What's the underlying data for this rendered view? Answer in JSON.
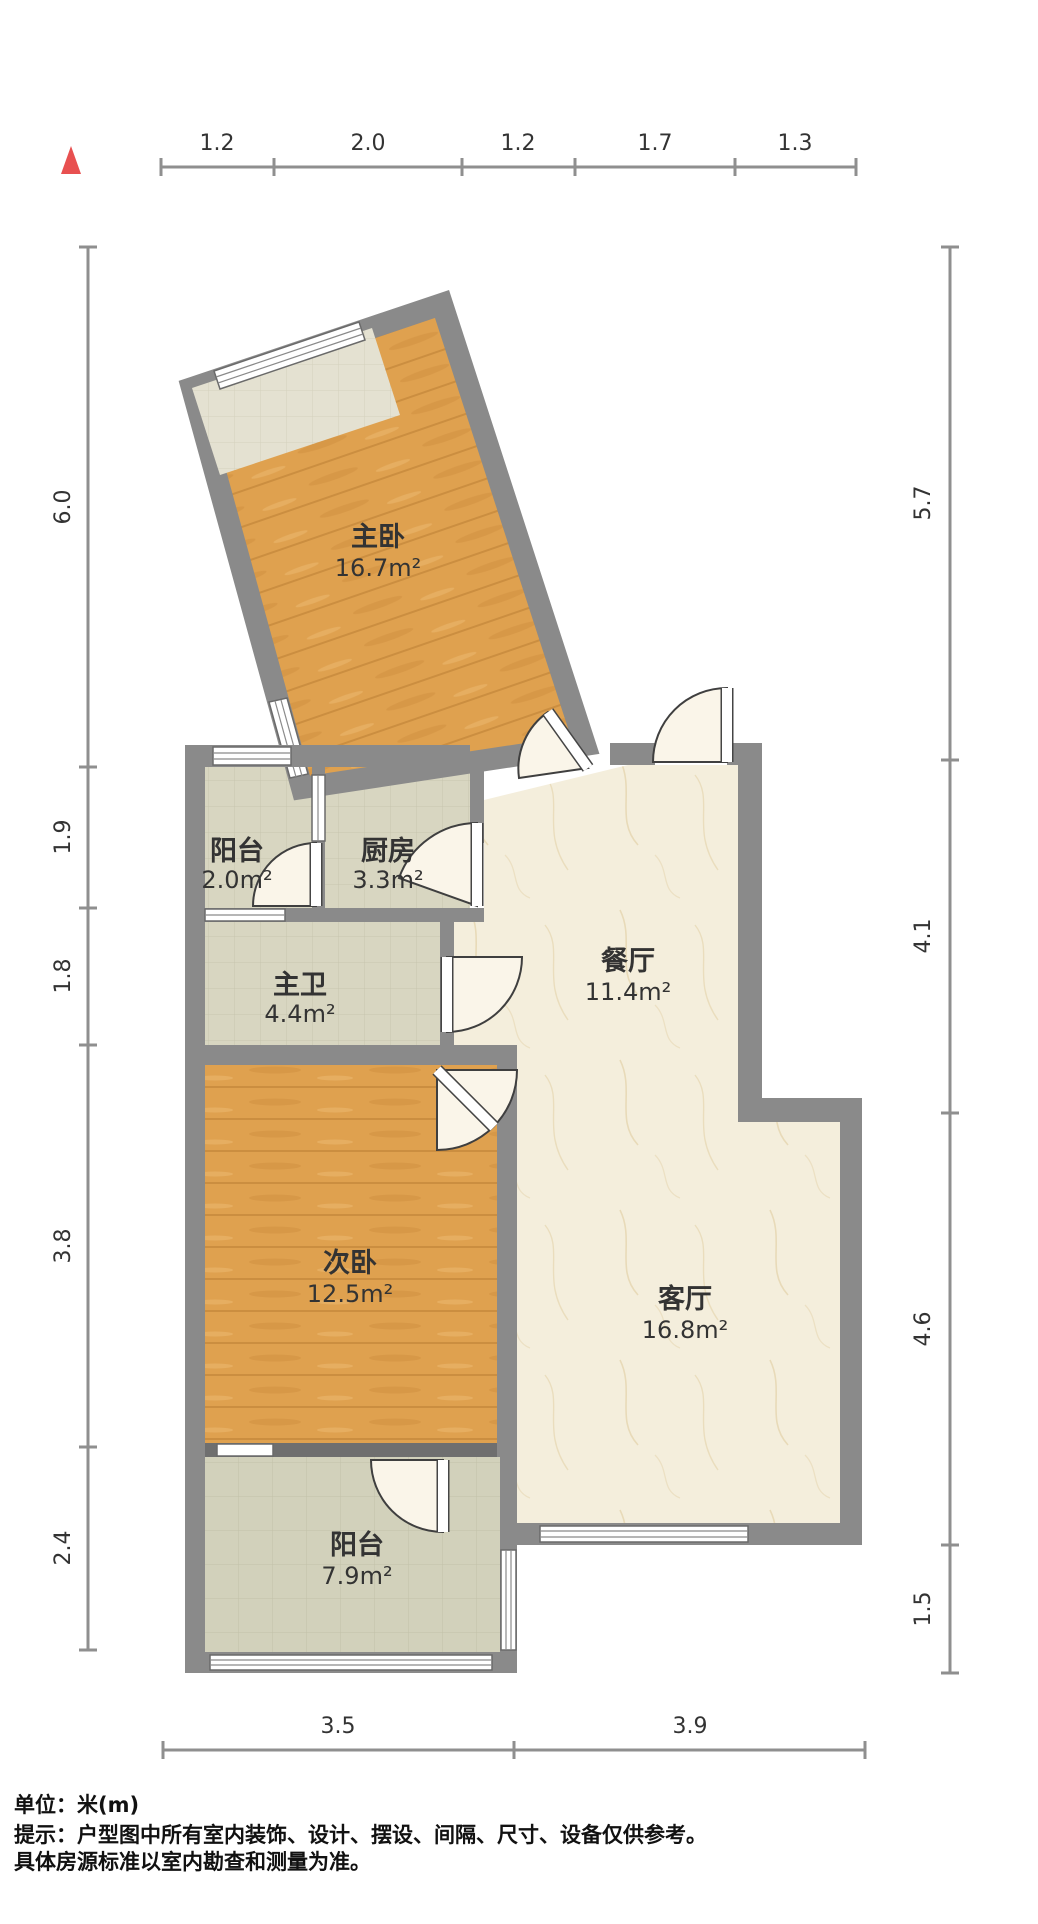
{
  "meta": {
    "type": "apartment-floor-plan"
  },
  "colors": {
    "wall": "#8a8a8a",
    "wood": "#dfa14f",
    "tile": "#d8d6c1",
    "marble": "#f4eedc",
    "north": "#e85050",
    "dim_line": "#8f8f8f",
    "label_text": "#333333",
    "footer_text": "#111111"
  },
  "rooms": [
    {
      "id": "master-bedroom",
      "name": "主卧",
      "area": "16.7m²"
    },
    {
      "id": "service-balcony",
      "name": "阳台",
      "area": "2.0m²"
    },
    {
      "id": "kitchen",
      "name": "厨房",
      "area": "3.3m²"
    },
    {
      "id": "master-bath",
      "name": "主卫",
      "area": "4.4m²"
    },
    {
      "id": "second-bedroom",
      "name": "次卧",
      "area": "12.5m²"
    },
    {
      "id": "dining-room",
      "name": "餐厅",
      "area": "11.4m²"
    },
    {
      "id": "living-room",
      "name": "客厅",
      "area": "16.8m²"
    },
    {
      "id": "south-balcony",
      "name": "阳台",
      "area": "7.9m²"
    }
  ],
  "dims": {
    "top": [
      "1.2",
      "2.0",
      "1.2",
      "1.7",
      "1.3"
    ],
    "left": [
      "6.0",
      "1.9",
      "1.8",
      "3.8",
      "2.4"
    ],
    "right": [
      "5.7",
      "4.1",
      "4.6",
      "1.5"
    ],
    "bottom": [
      "3.5",
      "3.9"
    ]
  },
  "footer": {
    "unit": "单位：米(m)",
    "tip1": "提示：户型图中所有室内装饰、设计、摆设、间隔、尺寸、设备仅供参考。",
    "tip2": "具体房源标准以室内勘查和测量为准。"
  }
}
